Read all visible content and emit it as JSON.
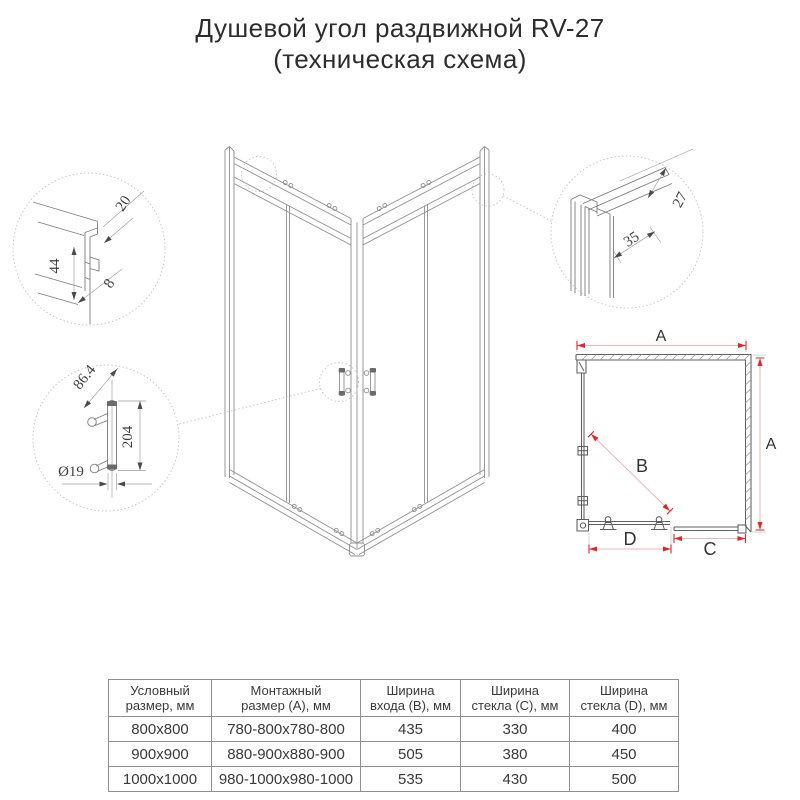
{
  "title": {
    "line1": "Душевой угол раздвижной RV-27",
    "line2": "(техническая схема)"
  },
  "diagram": {
    "detail_top_profile": {
      "dim_20": "20",
      "dim_44": "44",
      "dim_8": "8"
    },
    "detail_handle": {
      "dim_86_4": "86.4",
      "dim_204": "204",
      "dim_diameter": "Ø19"
    },
    "detail_corner_profile": {
      "dim_27": "27",
      "dim_35": "35"
    },
    "plan": {
      "dim_a_top": "A",
      "dim_a_right": "A",
      "dim_b": "B",
      "dim_c": "C",
      "dim_d": "D"
    }
  },
  "table": {
    "headers": [
      {
        "line1": "Условный",
        "line2": "размер, мм"
      },
      {
        "line1": "Монтажный",
        "line2": "размер (A), мм"
      },
      {
        "line1": "Ширина",
        "line2": "входа (B), мм"
      },
      {
        "line1": "Ширина",
        "line2": "стекла (C), мм"
      },
      {
        "line1": "Ширина",
        "line2": "стекла (D), мм"
      }
    ],
    "rows": [
      [
        "800x800",
        "780-800x780-800",
        "435",
        "330",
        "400"
      ],
      [
        "900x900",
        "880-900x880-900",
        "505",
        "380",
        "450"
      ],
      [
        "1000x1000",
        "980-1000x980-1000",
        "535",
        "430",
        "500"
      ]
    ]
  },
  "colors": {
    "accent_red": "#e3242b",
    "dim_line_pink": "#f0b6b9",
    "drawing_line": "#8f8f8f",
    "text": "#3a3a3a",
    "table_border": "#8f8f8f"
  }
}
